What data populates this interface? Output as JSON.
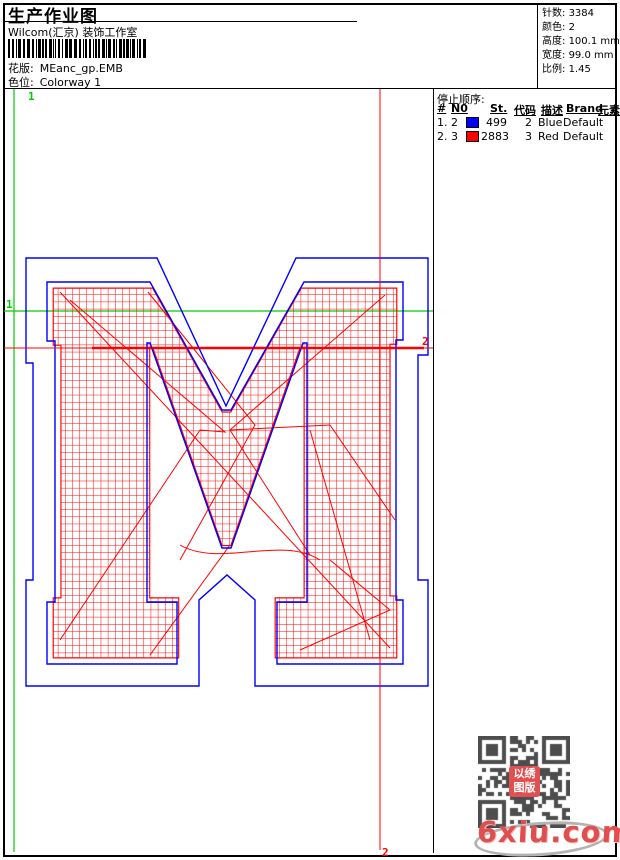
{
  "page": {
    "title": "生产作业图",
    "subtitle": "Wilcom(汇京) 装饰工作室",
    "pattern_label": "花版:",
    "pattern_value": "MEanc_gp.EMB",
    "colorway_label": "色位:",
    "colorway_value": "Colorway 1"
  },
  "info": {
    "stitches_label": "针数:",
    "stitches": "3384",
    "colors_label": "颜色:",
    "colors": "2",
    "height_label": "高度:",
    "height": "100.1 mm",
    "width_label": "宽度:",
    "width": "99.0 mm",
    "scale_label": "比例:",
    "scale": "1.45"
  },
  "stop_sequence": {
    "title": "停止顺序:",
    "columns": [
      "#",
      "N0",
      "St.",
      "代码",
      "描述",
      "Brand",
      "元素"
    ],
    "rows": [
      {
        "seq": "1.",
        "needle": "2",
        "swatch": "#0000ff",
        "st": "499",
        "code": "2",
        "desc": "Blue",
        "brand": "Default",
        "element": ""
      },
      {
        "seq": "2.",
        "needle": "3",
        "swatch": "#ff0000",
        "st": "2883",
        "code": "3",
        "desc": "Red",
        "brand": "Default",
        "element": ""
      }
    ]
  },
  "markers": {
    "start_label": "1",
    "end_label": "2"
  },
  "watermark": {
    "site": "6xiu.com",
    "seal_line1": "以绣",
    "seal_line2": "图版"
  },
  "colors": {
    "outline_blue": "#0000ff",
    "stitch_red": "#ff0000",
    "marker_green": "#00cc00",
    "swatch_blue": "#0000ff",
    "swatch_red": "#ff0000",
    "qr_gray": "#4d4d4d",
    "watermark_red": "#e04e4e",
    "border_black": "#000000"
  }
}
